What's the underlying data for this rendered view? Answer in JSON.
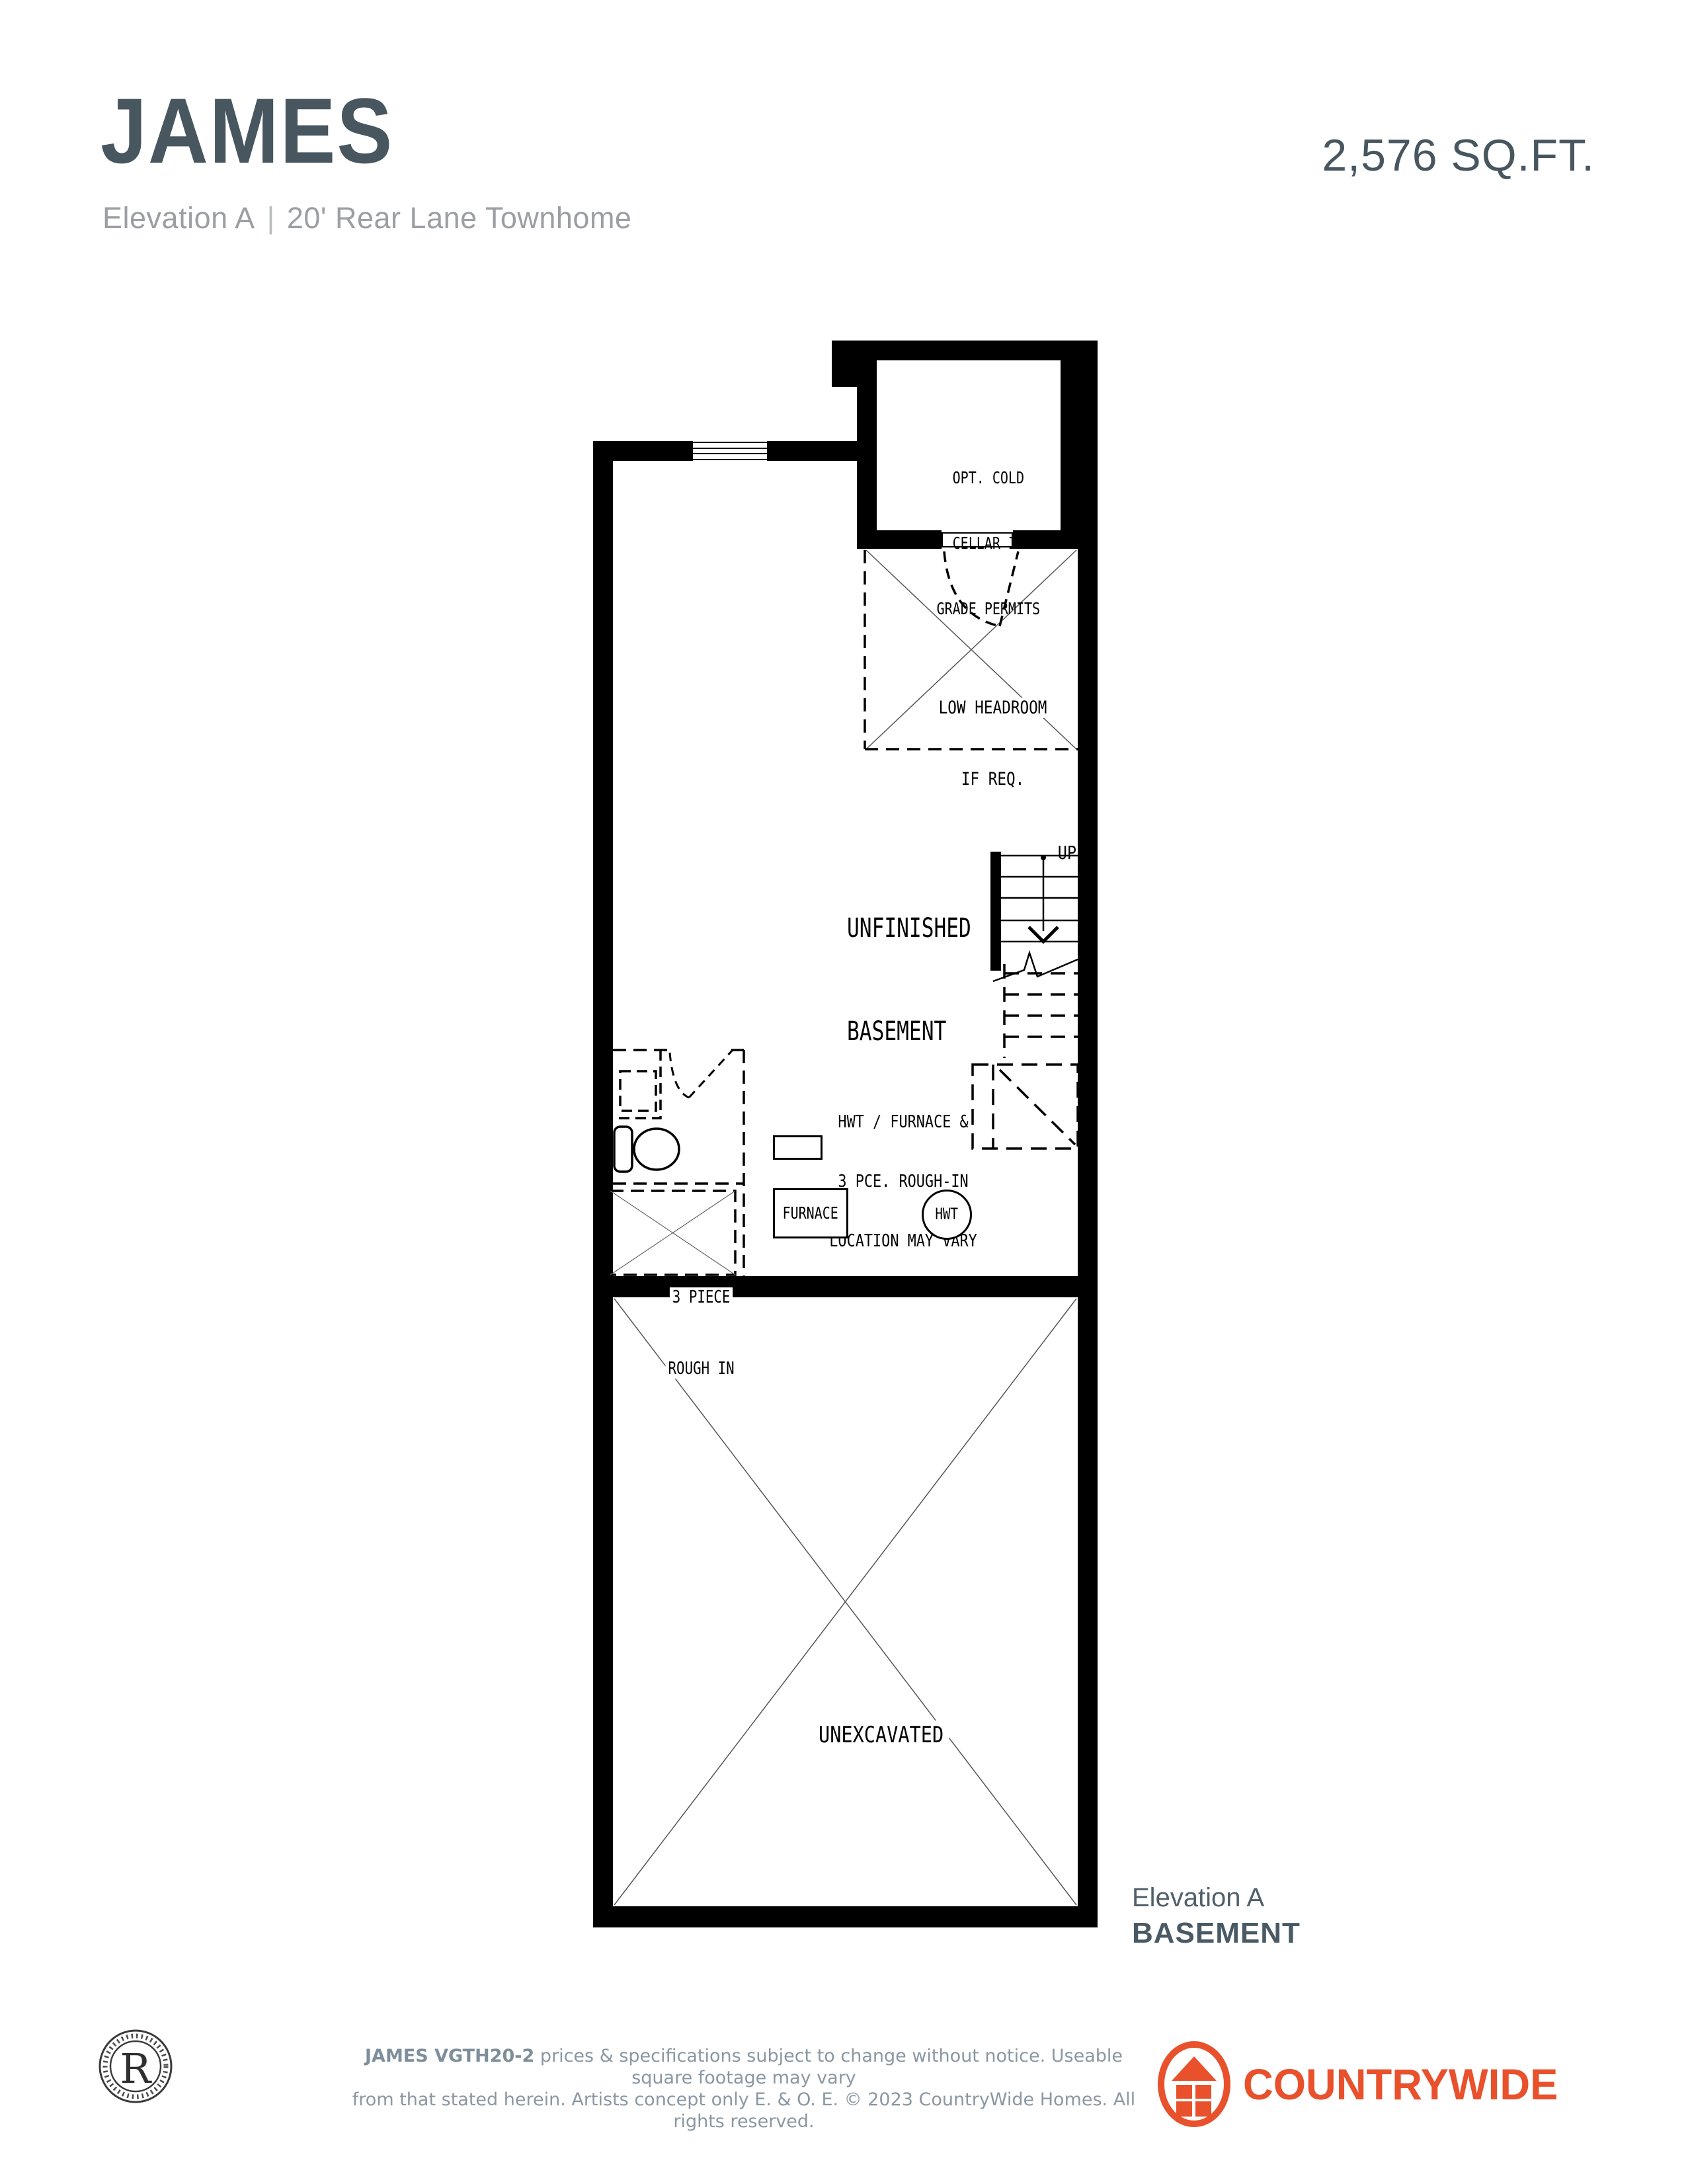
{
  "header": {
    "title": "JAMES",
    "elevation": "Elevation A",
    "separator": "|",
    "product": "20' Rear Lane Townhome",
    "sqft": "2,576 SQ.FT."
  },
  "plan": {
    "labels": {
      "cold_cellar": [
        "OPT. COLD",
        "CELLAR IF",
        "GRADE PERMITS"
      ],
      "low_headroom": [
        "LOW HEADROOM",
        "IF REQ."
      ],
      "unfinished_basement": [
        "UNFINISHED",
        "BASEMENT"
      ],
      "up": "UP",
      "mech_note": [
        "HWT / FURNACE &",
        "3 PCE. ROUGH-IN",
        "LOCATION MAY VARY"
      ],
      "furnace": "FURNACE",
      "hwt": "HWT",
      "rough_in": [
        "3 PIECE",
        "ROUGH IN"
      ],
      "unexcavated": "UNEXCAVATED"
    },
    "caption": {
      "elevation": "Elevation A",
      "level": "BASEMENT"
    }
  },
  "footer": {
    "seal_letter": "R",
    "disclaimer_bold": "JAMES VGTH20-2",
    "disclaimer_rest_line1": " prices & specifications subject to change without notice. Useable square footage may vary",
    "disclaimer_line2": "from that stated herein. Artists concept only E. & O. E. © 2023 CountryWide Homes. All rights reserved.",
    "brand": {
      "regular": "COUNTRY",
      "bold": "WIDE"
    }
  },
  "colors": {
    "slate": "#47565f",
    "subtitle_gray": "#9b9fa3",
    "footer_gray": "#8b97a2",
    "brand_orange": "#e8512c",
    "plan_black": "#000000"
  }
}
